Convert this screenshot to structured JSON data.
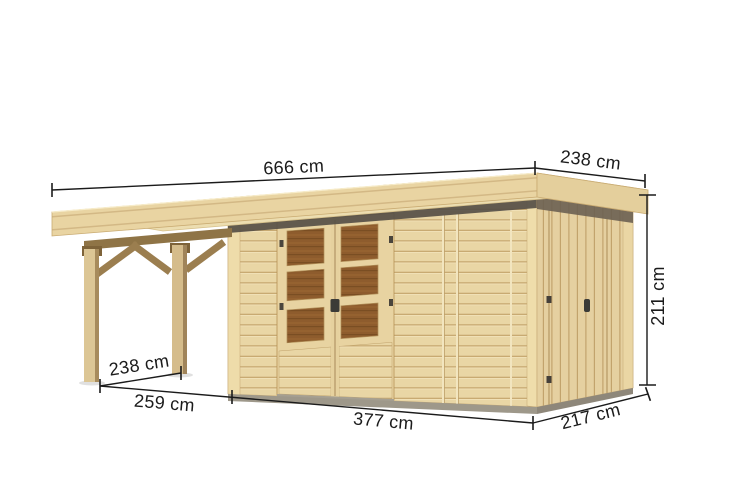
{
  "page": {
    "background": "#ffffff",
    "description": "Dimension diagram of a natural-wood flat-roof garden shed with glazed double doors, a side door and an attached lean-to canopy on the left"
  },
  "annotations": {
    "roof_total_width": "666 cm",
    "roof_depth": "238 cm",
    "building_height": "211 cm",
    "canopy_post_spacing": "238 cm",
    "canopy_total_width": "259 cm",
    "shed_front_width": "377 cm",
    "shed_side_depth": "217 cm"
  },
  "colors": {
    "wood_light": "#e9d6a5",
    "wood_roof_top": "#ecddb0",
    "wood_beam_dark": "#8f7446",
    "window_pane_brown": "#8e5c2d",
    "soffit_shadow": "#564f47",
    "foundation_gray": "#9e988a",
    "dimension_ink": "#1b1b1b"
  }
}
